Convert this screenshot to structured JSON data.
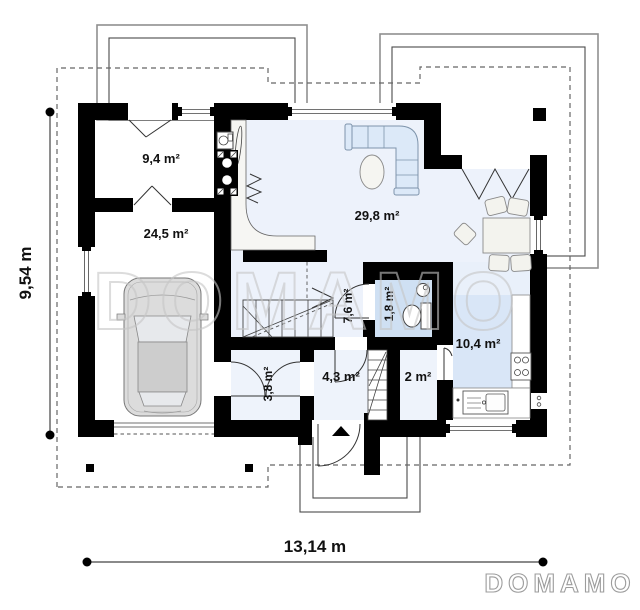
{
  "plan": {
    "watermark_text": "DOMAMO",
    "brand_logo": "DOMAMO",
    "rooms": [
      {
        "name": "vestibule",
        "area_label": "9,4 m²"
      },
      {
        "name": "garage",
        "area_label": "24,5 m²"
      },
      {
        "name": "living-room",
        "area_label": "29,8 m²"
      },
      {
        "name": "hall-stairs",
        "area_label": "7,6 m²"
      },
      {
        "name": "wc",
        "area_label": "1,8 m²"
      },
      {
        "name": "kitchen",
        "area_label": "10,4 m²"
      },
      {
        "name": "entry-hall",
        "area_label": "4,3 m²"
      },
      {
        "name": "pantry",
        "area_label": "2 m²"
      },
      {
        "name": "wardrobe",
        "area_label": "3,8 m²"
      }
    ],
    "dimensions": {
      "overall_width_label": "13,14 m",
      "overall_depth_label": "9,54 m"
    },
    "colors": {
      "wall": "#000000",
      "floor_light_blue": "#edf2fb",
      "floor_wc_blue": "#cfe0f3",
      "kitchen_rug_blue": "#d9e6f7",
      "watermark_gray": "#c6c6c6"
    }
  }
}
